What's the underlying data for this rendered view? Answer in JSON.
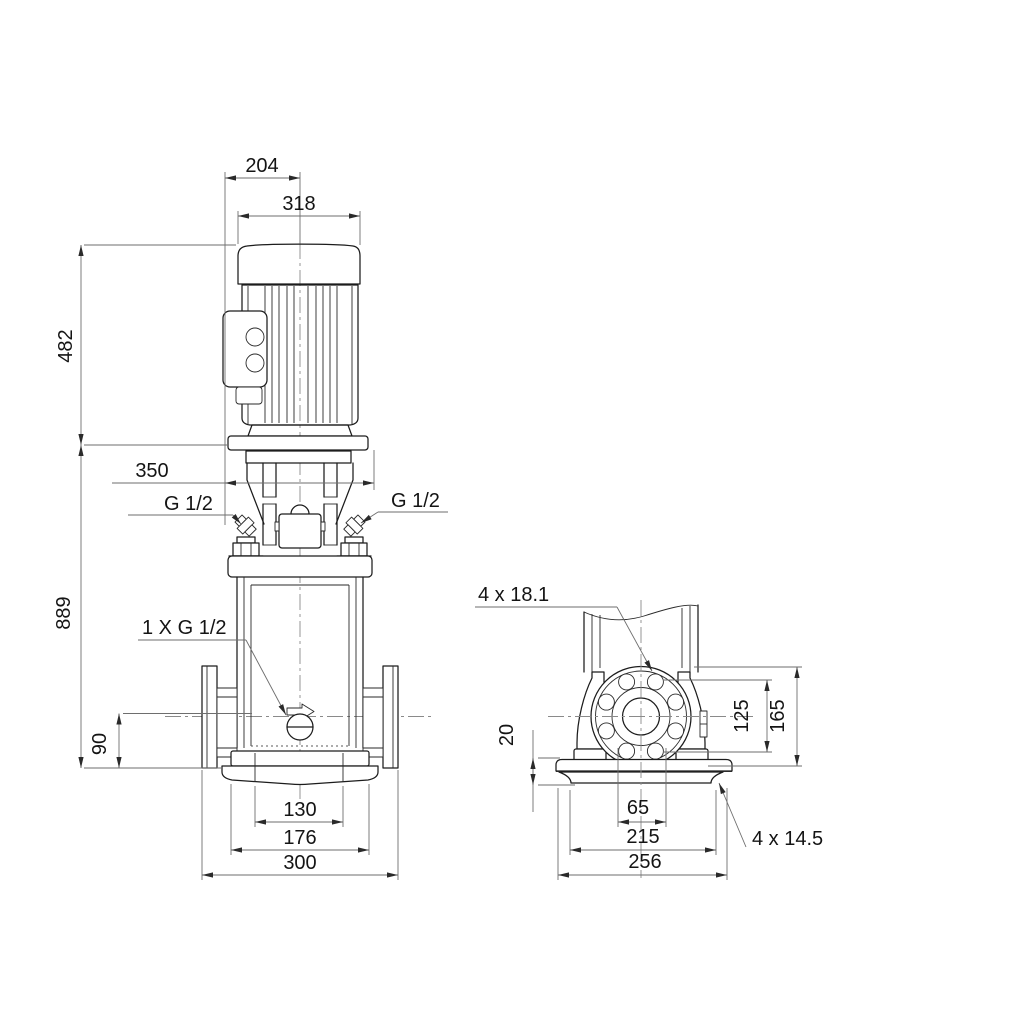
{
  "front_view": {
    "dims": {
      "motor_side_width": "204",
      "motor_width": "318",
      "motor_height": "482",
      "head_width": "350",
      "total_height": "889",
      "port_center_height": "90",
      "base_hole_span": "130",
      "base_mid_width": "176",
      "base_width": "300"
    },
    "labels": {
      "port_left": "G 1/2",
      "port_right": "G 1/2",
      "drain_port": "1 X G 1/2"
    }
  },
  "side_view": {
    "dims": {
      "flange_plate_thickness": "20",
      "bolt_circle": "125",
      "flange_od": "165",
      "port_span": "65",
      "base_mid_depth": "215",
      "base_depth": "256"
    },
    "labels": {
      "flange_holes": "4 x 18.1",
      "base_holes": "4 x 14.5"
    }
  }
}
